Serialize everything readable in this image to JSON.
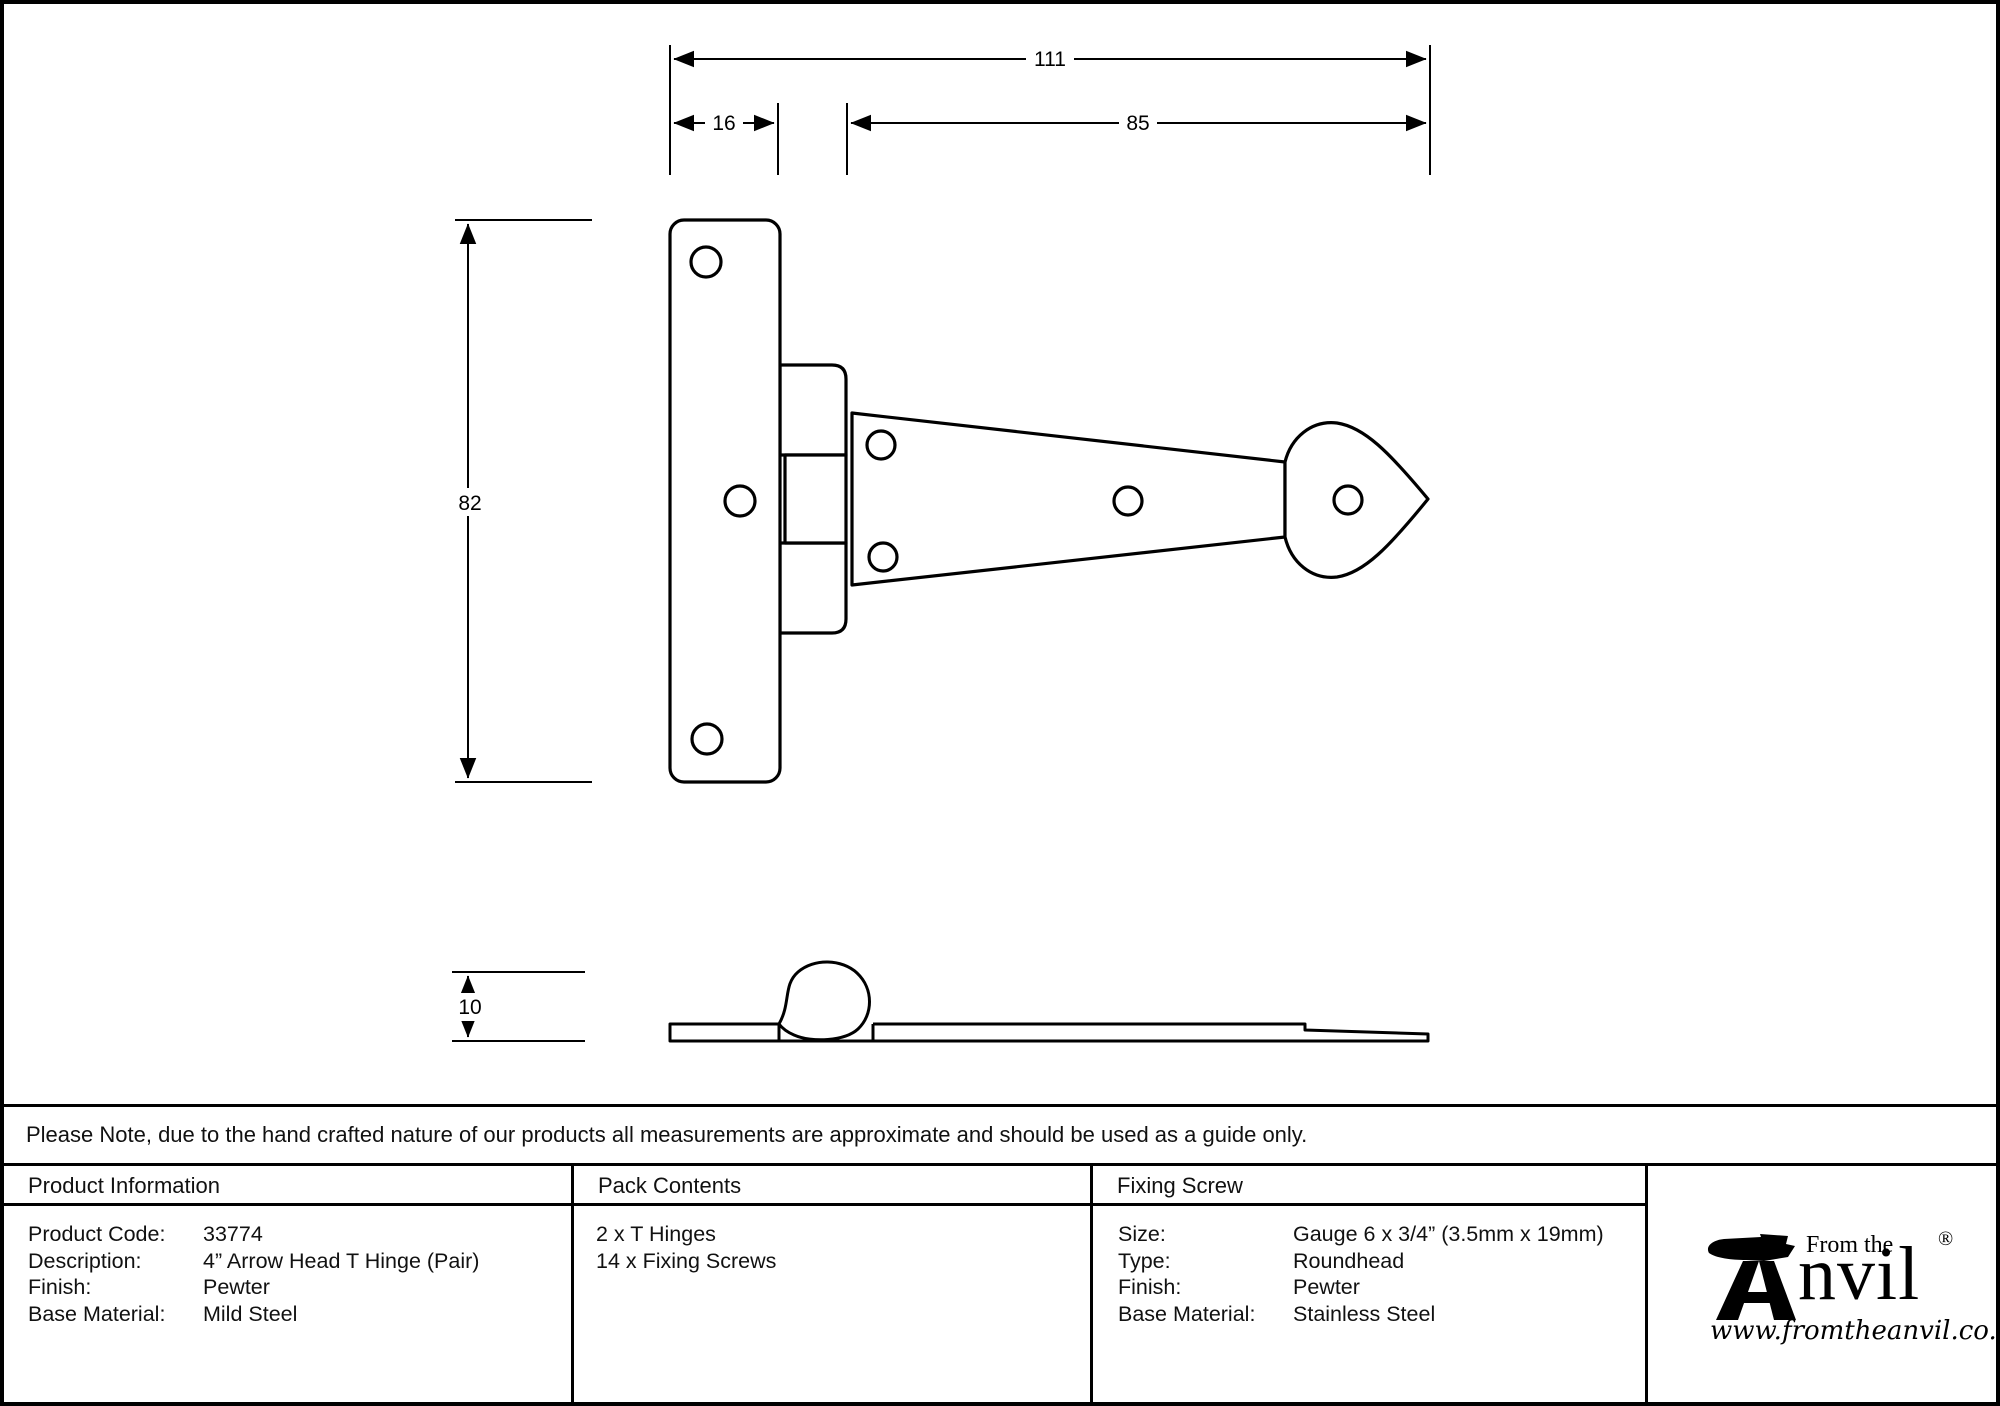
{
  "drawing": {
    "dims": {
      "overall_length": "111",
      "plate_width": "16",
      "strap_length": "85",
      "plate_height": "82",
      "thickness": "10"
    }
  },
  "note": {
    "text": "Please Note, due to the hand crafted nature of our products all measurements are approximate and should be used as a guide only."
  },
  "table": {
    "product_information": {
      "header": "Product Information",
      "rows": [
        {
          "label": "Product Code:",
          "value": "33774"
        },
        {
          "label": "Description:",
          "value": "4” Arrow Head T Hinge (Pair)"
        },
        {
          "label": "Finish:",
          "value": "Pewter"
        },
        {
          "label": "Base Material:",
          "value": "Mild Steel"
        }
      ]
    },
    "pack_contents": {
      "header": "Pack Contents",
      "items": [
        "2 x T Hinges",
        "14 x Fixing Screws"
      ]
    },
    "fixing_screw": {
      "header": "Fixing Screw",
      "rows": [
        {
          "label": "Size:",
          "value": "Gauge 6 x 3/4” (3.5mm x 19mm)"
        },
        {
          "label": "Type:",
          "value": "Roundhead"
        },
        {
          "label": "Finish:",
          "value": "Pewter"
        },
        {
          "label": "Base Material:",
          "value": "Stainless Steel"
        }
      ]
    }
  },
  "logo": {
    "from_the": "From the",
    "brand": "nvil",
    "registered": "®",
    "url": "www.fromtheanvil.co.uk"
  },
  "colors": {
    "line": "#000000",
    "background": "#ffffff"
  }
}
